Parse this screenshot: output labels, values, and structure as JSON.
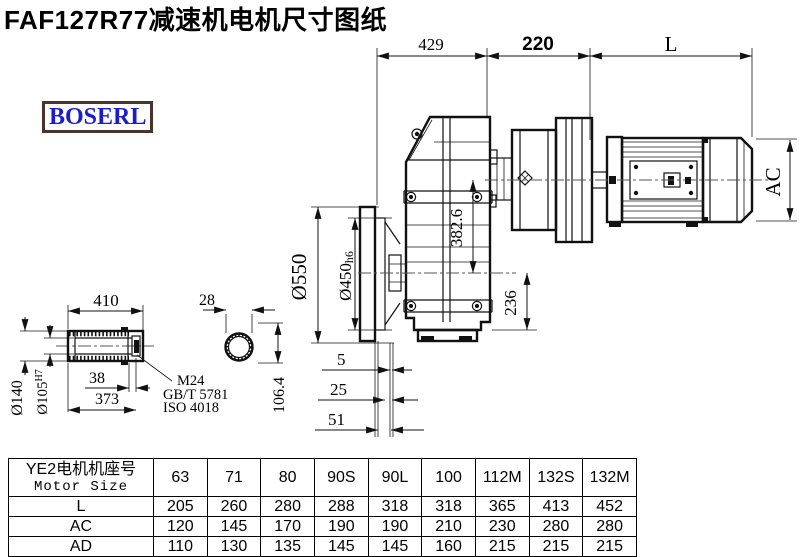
{
  "title": "FAF127R77减速机电机尺寸图纸",
  "logo_text": "BOSERL",
  "colors": {
    "line": "#111111",
    "logo_text": "#1b1bd0",
    "logo_border": "#4c332c",
    "title": "#000000"
  },
  "drawing": {
    "top": {
      "width_gear": "429",
      "width_adapter": "220",
      "motor_length": "L"
    },
    "main": {
      "flange_od": "Ø550",
      "spigot_d": "Ø450",
      "spigot_tol": "h6",
      "axis_distance": "382.6",
      "axis_to_base": "236",
      "motor_od": "AC",
      "offset_a": "5",
      "offset_b": "25",
      "offset_c": "51"
    },
    "shaft_view": {
      "length": "410",
      "hub_od": "Ø140",
      "bore_d": "Ø105",
      "bore_tol": "H7",
      "end_step": "38",
      "bore_depth": "373",
      "note_thread": "M24",
      "note_std1": "GB/T 5781",
      "note_std2": "ISO 4018"
    },
    "section_view": {
      "width": "28",
      "height": "106.4"
    }
  },
  "table": {
    "header_cn": "YE2电机机座号",
    "header_en": "Motor Size",
    "sizes": [
      "63",
      "71",
      "80",
      "90S",
      "90L",
      "100",
      "112M",
      "132S",
      "132M"
    ],
    "rows": [
      {
        "label": "L",
        "values": [
          "205",
          "260",
          "280",
          "288",
          "318",
          "318",
          "365",
          "413",
          "452"
        ]
      },
      {
        "label": "AC",
        "values": [
          "120",
          "145",
          "170",
          "190",
          "190",
          "210",
          "230",
          "280",
          "280"
        ]
      },
      {
        "label": "AD",
        "values": [
          "110",
          "130",
          "135",
          "145",
          "145",
          "160",
          "215",
          "215",
          "215"
        ]
      }
    ]
  }
}
